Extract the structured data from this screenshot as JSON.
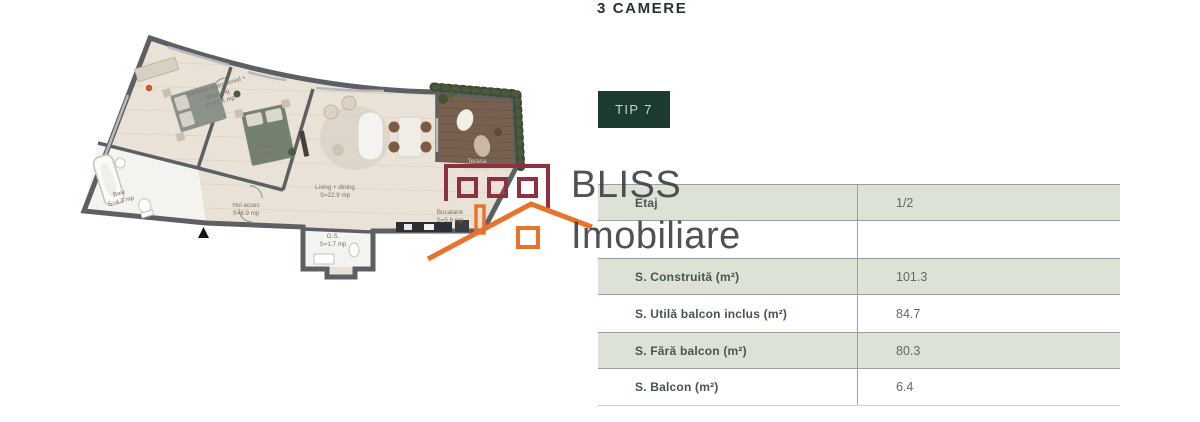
{
  "header": {
    "title": "3 CAMERE",
    "type_badge": "TIP 7"
  },
  "watermark": {
    "brand_line1": "BLISS",
    "brand_line2": "Imobiliare"
  },
  "colors": {
    "accent_dark_green": "#1c3a31",
    "table_row_green": "#dce3d6",
    "logo_maroon": "#8e3040",
    "logo_orange": "#e8742b",
    "plan_wall_gray": "#5c6064",
    "plan_floor_beige": "#eae2d6",
    "terrace_brown": "#77604f"
  },
  "floorplan": {
    "icons": {
      "north_marker": "triangle-up",
      "camera_marker": "360-camera-dot"
    },
    "rooms": [
      {
        "lines": [
          "Dormitor matrimonial +",
          "dressing",
          "S=17.4 mp"
        ]
      },
      {
        "lines": [
          "Baie",
          "S=4.3 mp"
        ]
      },
      {
        "lines": [
          "Dormitor 1",
          "S=13.1 mp"
        ]
      },
      {
        "lines": [
          "Hol acces",
          "S=6.9 mp"
        ]
      },
      {
        "lines": [
          "Living + dining",
          "S=22.9 mp"
        ]
      },
      {
        "lines": [
          "G.S.",
          "S=1.7 mp"
        ]
      },
      {
        "lines": [
          "Bucatarie",
          "S=5.8 mp"
        ]
      },
      {
        "lines": [
          "Terasa",
          "S=6.4 mp"
        ]
      }
    ]
  },
  "table": {
    "rows": [
      {
        "label": "Etaj",
        "value": "1/2"
      },
      {
        "label": "",
        "value": ""
      },
      {
        "label": "S. Construită (m²)",
        "value": "101.3"
      },
      {
        "label": "S. Utilă balcon inclus (m²)",
        "value": "84.7"
      },
      {
        "label": "S. Fără balcon (m²)",
        "value": "80.3"
      },
      {
        "label": "S. Balcon (m²)",
        "value": "6.4"
      }
    ]
  }
}
